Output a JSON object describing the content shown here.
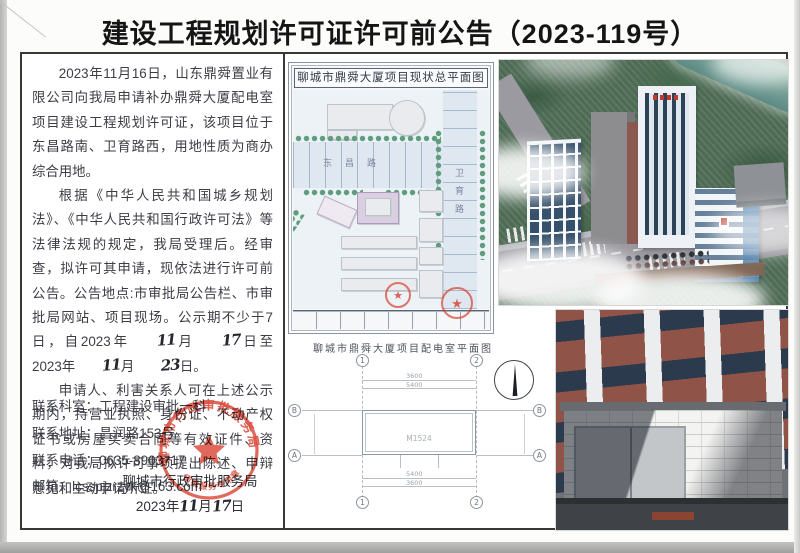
{
  "page_title": "建设工程规划许可证许可前公告（2023-119号）",
  "notice": {
    "p1": "2023年11月16日，山东鼎舜置业有限公司向我局申请补办鼎舜大厦配电室项目建设工程规划许可证，该项目位于东昌路南、卫育路西，用地性质为商办综合用地。",
    "p2": {
      "a": "根据《中华人民共和国城乡规划法》、《中华人民共和国行政许可法》等法律法规的规定，我局受理后。经审查，拟许可其申请，现依法进行许可前公告。公告地点:市审批局公告栏、市审批局网站、项目现场。公示期不少于7日，自2023年",
      "hw_month1": "11",
      "b": "月",
      "hw_day1": "17",
      "c": "日至2023年",
      "hw_month2": "11",
      "d": "月",
      "hw_day2": "23",
      "e": "日。"
    },
    "p3": "申请人、利害关系人可在上述公示期内，持营业执照、身份证、不动产权证书或房屋买卖合同等有效证件、资料，对我局拟许可事项提出陈述、申辩意见和主动申请听证。"
  },
  "contact": {
    "room": "联系科室：工程建设审批一科",
    "address": "联系地址：昌润路153号",
    "phone": "联系电话：0635-8903717",
    "email": "邮箱：lcsspjzrzyk@163.com"
  },
  "footer": {
    "issuer": "聊城市行政审批服务局",
    "date": {
      "a": "2023年",
      "hw_month": "11",
      "b": "月",
      "hw_day": "17",
      "c": "日"
    }
  },
  "seal": {
    "ring_text": "聊城市行政审批服务局",
    "sub_text": "审批服务专用章",
    "color": "#d8402f"
  },
  "site_plan": {
    "title": "聊城市鼎舜大厦项目现状总平面图",
    "road_h": "东昌路",
    "road_v": "卫育路"
  },
  "floor_plan": {
    "title": "聊城市鼎舜大厦项目配电室平面图",
    "door_label": "M1524",
    "dims": {
      "top_outer": "3600",
      "top_inner": "5400",
      "bottom_inner": "5400",
      "bottom_outer": "3600"
    },
    "axes": {
      "n1": "1",
      "n2": "2",
      "a": "A",
      "b": "B"
    }
  }
}
